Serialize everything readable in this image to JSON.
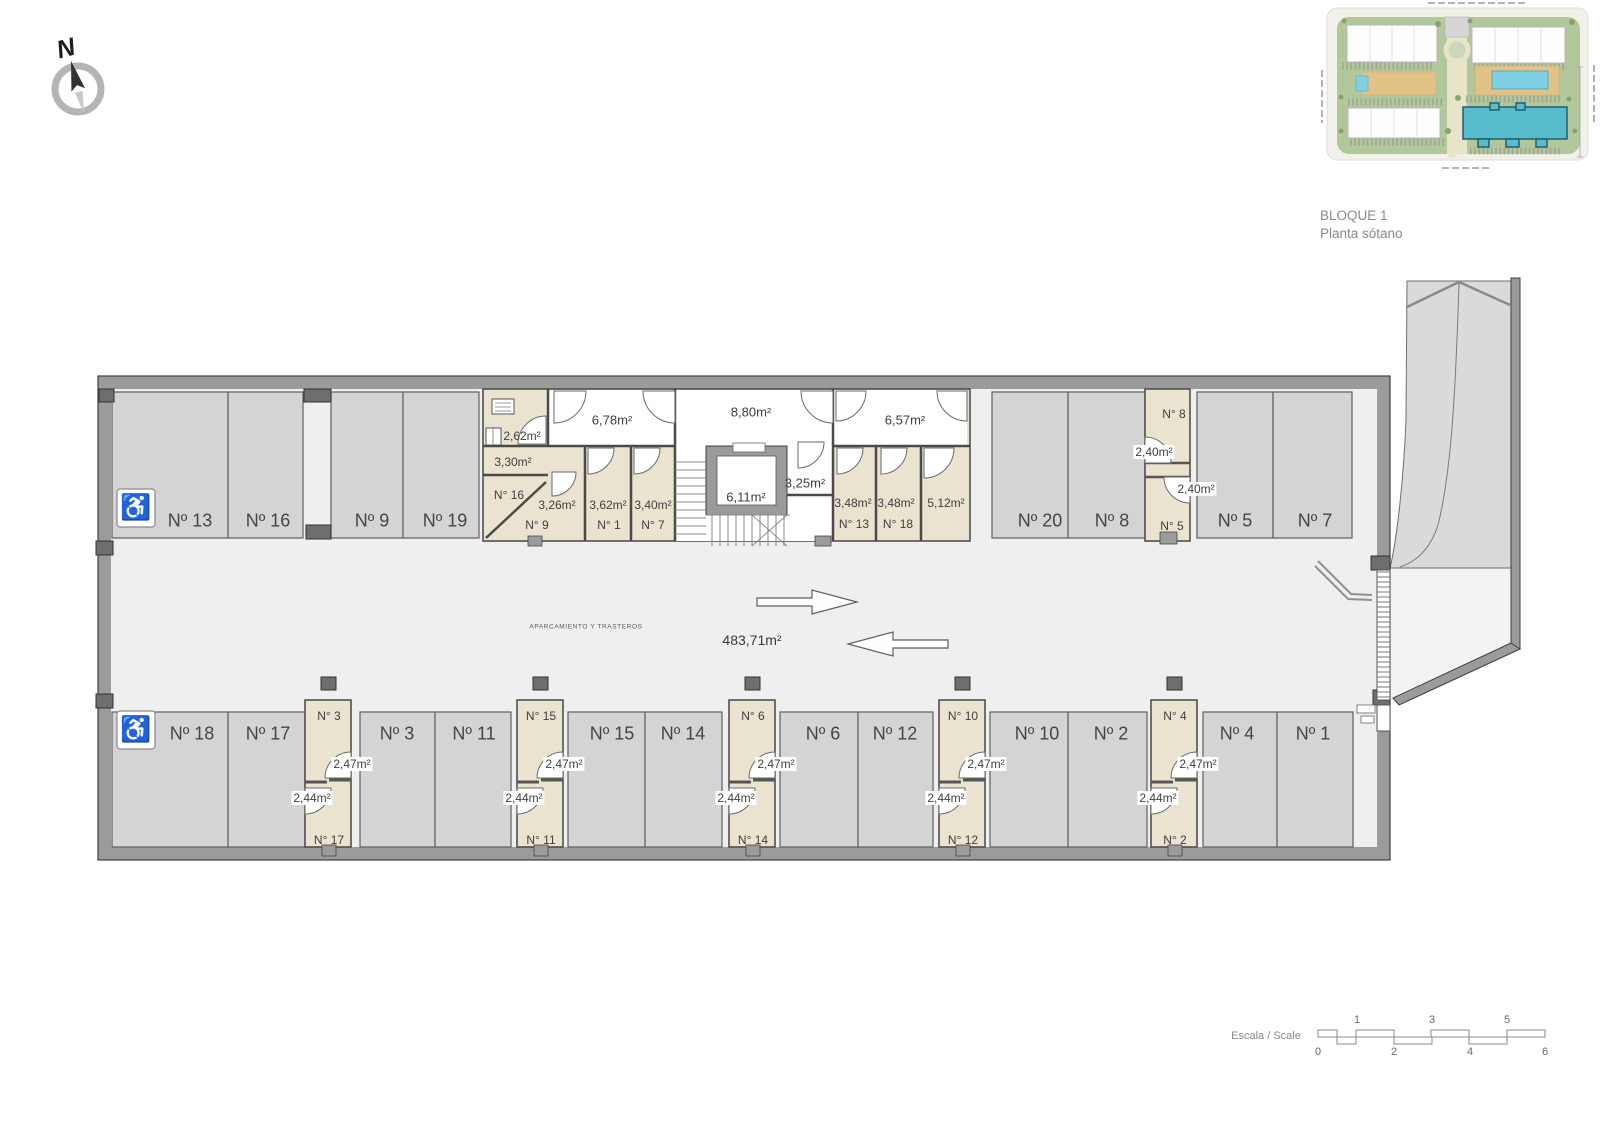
{
  "header": {
    "block": "BLOQUE 1",
    "floor": "Planta sótano"
  },
  "compass": {
    "north": "N"
  },
  "accessibility": {
    "wheelchair_icon": "♿"
  },
  "aisle": {
    "zone": "APARCAMIENTO Y TRASTEROS",
    "area": "483,71m²"
  },
  "halls": {
    "h678": "6,78m²",
    "h880": "8,80m²",
    "h657": "6,57m²",
    "lift": "6,11m²",
    "r325": "3,25m²"
  },
  "parking": {
    "top": [
      "Nº 13",
      "Nº 16",
      "Nº 9",
      "Nº 19",
      "Nº 20",
      "Nº 8",
      "Nº 5",
      "Nº 7"
    ],
    "bottom": [
      "Nº 18",
      "Nº 17",
      "Nº 3",
      "Nº 11",
      "Nº 15",
      "Nº 14",
      "Nº 6",
      "Nº 12",
      "Nº 10",
      "Nº 2",
      "Nº 4",
      "Nº 1"
    ]
  },
  "trasteros": {
    "t262": {
      "area": "2,62m²"
    },
    "t16": {
      "area": "3,30m²",
      "no": "N° 16"
    },
    "t9": {
      "area": "3,26m²",
      "no": "N° 9"
    },
    "t1": {
      "area": "3,62m²",
      "no": "N° 1"
    },
    "t7": {
      "area": "3,40m²",
      "no": "N° 7"
    },
    "t13": {
      "area": "3,48m²",
      "no": "N° 13"
    },
    "t18": {
      "area": "3,48m²",
      "no": "N° 18"
    },
    "t512": {
      "area": "5,12m²"
    },
    "t8": {
      "area": "2,40m²",
      "no": "N° 8"
    },
    "t5": {
      "area": "2,40m²",
      "no": "N° 5"
    },
    "cols_bottom": [
      {
        "top_no": "N° 3",
        "top_area": "2,47m²",
        "bottom_area": "2,44m²",
        "bottom_no": "N° 17"
      },
      {
        "top_no": "N° 15",
        "top_area": "2,47m²",
        "bottom_area": "2,44m²",
        "bottom_no": "N° 11"
      },
      {
        "top_no": "N° 6",
        "top_area": "2,47m²",
        "bottom_area": "2,44m²",
        "bottom_no": "N° 14"
      },
      {
        "top_no": "N° 10",
        "top_area": "2,47m²",
        "bottom_area": "2,44m²",
        "bottom_no": "N° 12"
      },
      {
        "top_no": "N° 4",
        "top_area": "2,47m²",
        "bottom_area": "2,44m²",
        "bottom_no": "N° 2"
      }
    ]
  },
  "scale": {
    "label": "Escala / Scale",
    "above": [
      "1",
      "3",
      "5"
    ],
    "below": [
      "0",
      "2",
      "4",
      "6"
    ]
  }
}
